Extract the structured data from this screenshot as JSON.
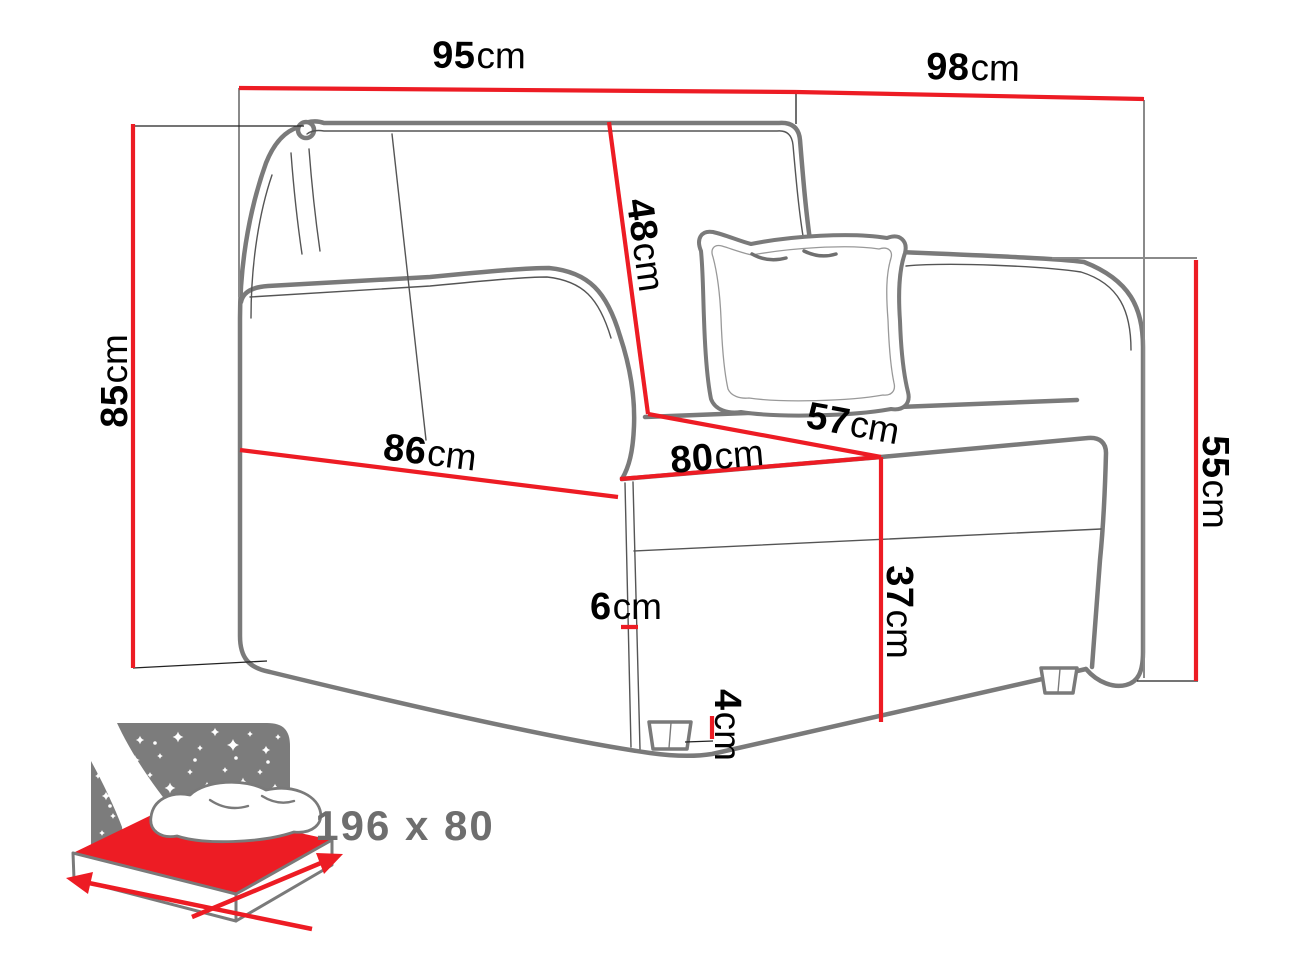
{
  "page": {
    "background": "#ffffff",
    "kind": "furniture dimension diagram"
  },
  "dims": [
    {
      "name": "top-width",
      "value": "95",
      "unit": "cm"
    },
    {
      "name": "top-depth",
      "value": "98",
      "unit": "cm"
    },
    {
      "name": "overall-height",
      "value": "85",
      "unit": "cm"
    },
    {
      "name": "backrest-length",
      "value": "48",
      "unit": "cm"
    },
    {
      "name": "seat-depth",
      "value": "57",
      "unit": "cm"
    },
    {
      "name": "seat-front-width",
      "value": "80",
      "unit": "cm"
    },
    {
      "name": "side-width",
      "value": "86",
      "unit": "cm"
    },
    {
      "name": "seat-height",
      "value": "37",
      "unit": "cm"
    },
    {
      "name": "armrest-height",
      "value": "55",
      "unit": "cm"
    },
    {
      "name": "front-offset",
      "value": "6",
      "unit": "cm"
    },
    {
      "name": "leg-height",
      "value": "4",
      "unit": "cm"
    }
  ],
  "sleeping": {
    "label": "196 x 80"
  },
  "colors": {
    "dimension_red": "#ed1c24",
    "outline_gray": "#7a7a7a",
    "icon_gray": "#7c7c7c",
    "label_gray": "#6e6e6e",
    "text_black": "#000000"
  }
}
